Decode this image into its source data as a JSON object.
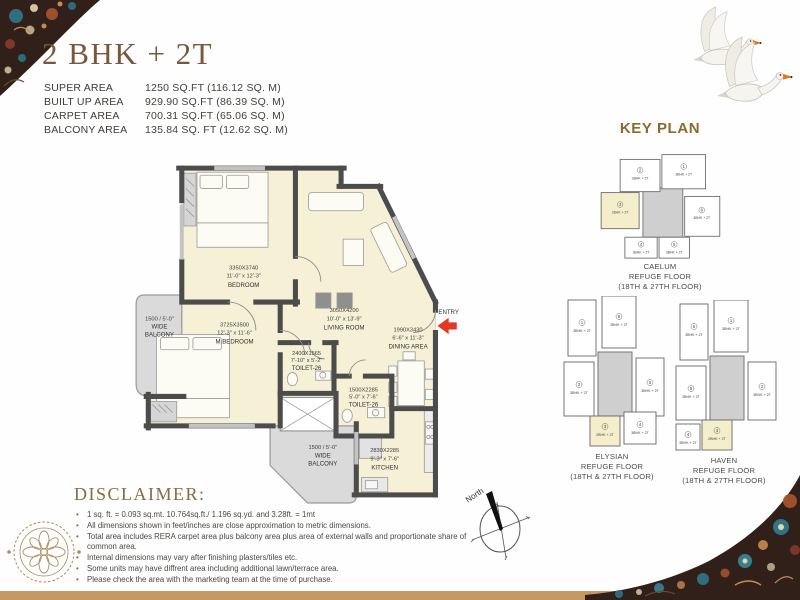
{
  "title": "2 BHK + 2T",
  "areas": {
    "rows": [
      {
        "label": "SUPER AREA",
        "value": "1250 SQ.FT (116.12 SQ. M)"
      },
      {
        "label": "BUILT UP AREA",
        "value": "929.90 SQ.FT (86.39 SQ. M)"
      },
      {
        "label": "CARPET AREA",
        "value": "700.31 SQ.FT (65.06 SQ. M)"
      },
      {
        "label": "BALCONY AREA",
        "value": "135.84 SQ. FT (12.62 SQ. M)"
      }
    ]
  },
  "floor_plan": {
    "entry_label": "ENTRY",
    "north_label": "North",
    "rooms": {
      "bedroom": {
        "dim": "3350X3740",
        "ft": "11'-0\" x 12'-3\"",
        "name": "BEDROOM"
      },
      "living": {
        "dim": "3050X4200",
        "ft": "10'-0\" x 13'-9\"",
        "name": "LIVING ROOM"
      },
      "mbedroom": {
        "dim": "3725X3500",
        "ft": "12'-3\" x 11'-6\"",
        "name": "M.BEDROOM"
      },
      "toilet_a": {
        "dim": "2400X1565",
        "ft": "7'-10\" x 5'-2\"",
        "name": "TOILET-26"
      },
      "toilet_b": {
        "dim": "1500X2285",
        "ft": "5'-0\" x 7'-6\"",
        "name": "TOILET-26"
      },
      "dining": {
        "dim": "1990X3430",
        "ft": "6'-6\" x 11'-3\"",
        "name": "DINING AREA"
      },
      "kitchen": {
        "dim": "2830X2285",
        "ft": "9'-3\" x 7'-6\"",
        "name": "KITCHEN"
      },
      "balcony_left": {
        "l1": "1500 / 5'-0\"",
        "l2": "WIDE",
        "l3": "BALCONY"
      },
      "balcony_bottom": {
        "l1": "1500 / 5'-0\"",
        "l2": "WIDE",
        "l3": "BALCONY"
      }
    }
  },
  "key_plan": {
    "title": "KEY PLAN",
    "clusters": [
      {
        "caption": [
          "CAELUM",
          "REFUGE FLOOR",
          "(18TH & 27TH FLOOR)"
        ],
        "units": [
          {
            "num": "2",
            "label": "3BHK + 2T"
          },
          {
            "num": "1",
            "label": "3BHK + 2T"
          },
          {
            "num": "3",
            "label": "2BHK + 2T"
          },
          {
            "num": "6",
            "label": "3BHK + 2T"
          },
          {
            "num": "4",
            "label": "3BHK + 2T"
          },
          {
            "num": "5",
            "label": "3BHK + 2T"
          }
        ]
      },
      {
        "caption": [
          "ELYSIAN",
          "REFUGE FLOOR",
          "(18TH & 27TH FLOOR)"
        ],
        "units": [
          {
            "num": "1",
            "label": "3BHK + 2T"
          },
          {
            "num": "6",
            "label": "3BHK + 2T"
          },
          {
            "num": "2",
            "label": "3BHK + 2T"
          },
          {
            "num": "5",
            "label": "3BHK + 2T"
          },
          {
            "num": "3",
            "label": "2BHK + 2T"
          },
          {
            "num": "4",
            "label": "3BHK + 2T"
          }
        ]
      },
      {
        "caption": [
          "HAVEN",
          "REFUGE FLOOR",
          "(18TH & 27TH FLOOR)"
        ],
        "units": [
          {
            "num": "6",
            "label": "3BHK + 2T"
          },
          {
            "num": "1",
            "label": "3BHK + 2T"
          },
          {
            "num": "5",
            "label": "3BHK + 2T"
          },
          {
            "num": "2",
            "label": "3BHK + 2T"
          },
          {
            "num": "3",
            "label": "2BHK + 2T"
          },
          {
            "num": "4",
            "label": "3BHK + 2T"
          }
        ]
      }
    ]
  },
  "disclaimer": {
    "title": "DISCLAIMER:",
    "bullets": [
      "1 sq. ft. = 0.093 sq.mt. 10.764sq.ft./ 1.196 sq.yd. and 3.28ft. = 1mt",
      "All dimensions shown in feet/inches are close approximation to metric dimensions.",
      "Total area includes RERA carpet area plus balcony area plus area of external walls and proportionate share of common area.",
      "Internal dimensions may vary after finishing plasters/tiles etc.",
      "Some units may have diffrent area including additional lawn/terrace area.",
      "Please check the area with the marketing team at the time of purchase."
    ]
  },
  "colors": {
    "accent_gold": "#8a6a2f",
    "title_brown": "#77583a",
    "room_fill": "#f6f1d6",
    "balcony_fill": "#dadada",
    "wall": "#4c4c4c",
    "entry_arrow": "#e03a22",
    "bottom_band": "#c49a62"
  }
}
